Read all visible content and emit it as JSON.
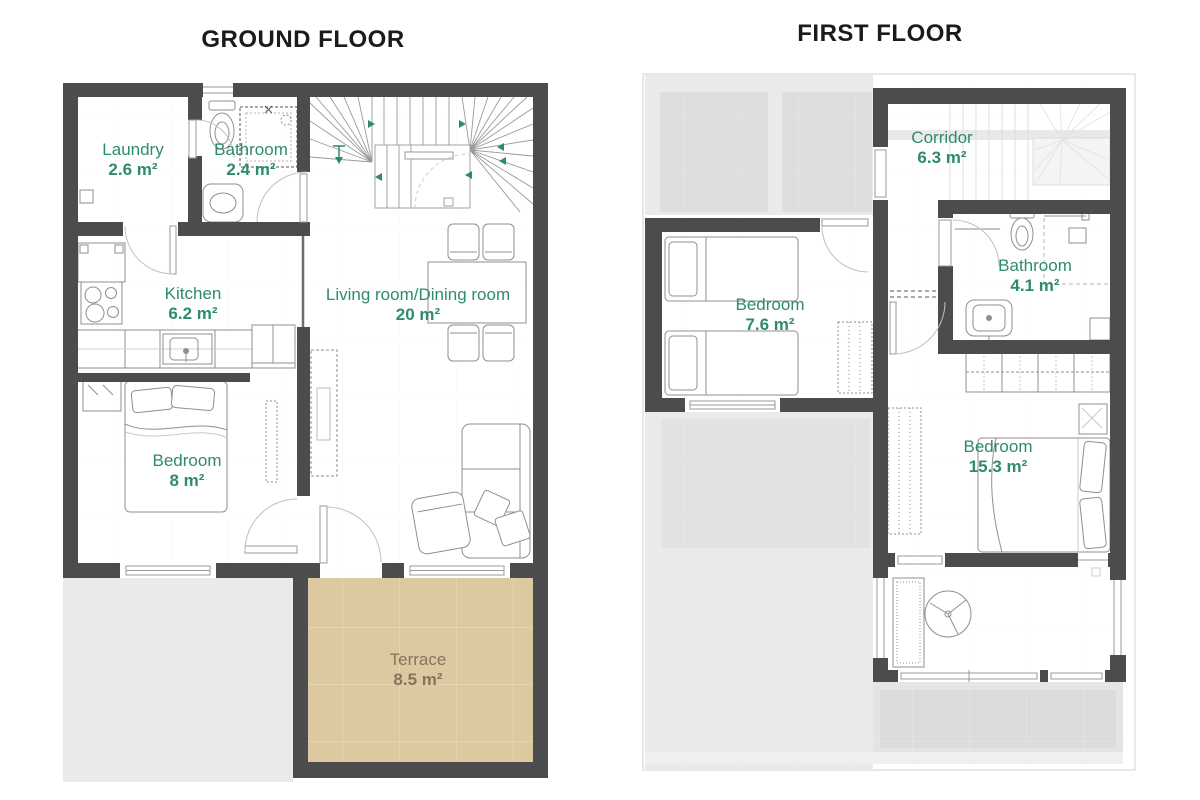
{
  "ground_floor": {
    "title": "GROUND FLOOR",
    "rooms": [
      {
        "name": "Laundry",
        "area": "2.6 m²"
      },
      {
        "name": "Bathroom",
        "area": "2.4 m²"
      },
      {
        "name": "Kitchen",
        "area": "6.2 m²"
      },
      {
        "name": "Living room/Dining room",
        "area": "20 m²"
      },
      {
        "name": "Bedroom",
        "area": "8 m²"
      },
      {
        "name": "Terrace",
        "area": "8.5 m²"
      }
    ]
  },
  "first_floor": {
    "title": "FIRST FLOOR",
    "rooms": [
      {
        "name": "Corridor",
        "area": "6.3 m²"
      },
      {
        "name": "Bathroom",
        "area": "4.1 m²"
      },
      {
        "name": "Bedroom",
        "area": "7.6 m²"
      },
      {
        "name": "Bedroom",
        "area": "15.3 m²"
      }
    ]
  },
  "colors": {
    "wall": "#4c4c4e",
    "label_green": "#2e8a71",
    "terrace_fill": "#dcc9a0",
    "terrace_text": "#84755a",
    "paving_gray": "#eaeaea"
  }
}
